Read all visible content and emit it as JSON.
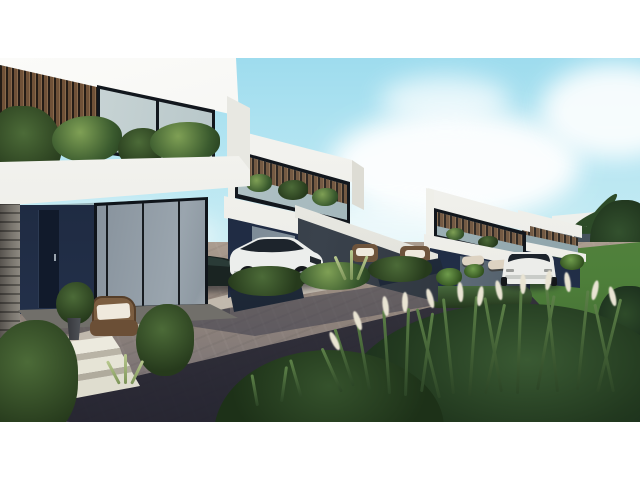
{
  "image": {
    "type": "3d-architectural-rendering",
    "subject": "Modern luxury villa development: row of white two-story villas with dark navy lower walls and wood-slat accents along a dark paver street, letterboxed with white bars",
    "elements": {
      "sky": "light blue sky with soft white clouds",
      "villa_1": "foreground villa with wood slat screen, glass balcony with plants, dark navy ground floor, wicker chair, white steps",
      "villa_2": "second villa with carport, white SUV and dark sports car parked in front",
      "villa_3": "third villa with patio loungers",
      "villa_4": "fourth receding villa",
      "distant_villa": "low flat-roof villa in far background right",
      "sedan": "white sedan driving away on street",
      "street": "herringbone paver street with long diagonal shadows",
      "landscaping": "hedges, planters, sunlit lawn, ornamental fountain grasses with white plumes, palm tree at right edge"
    }
  },
  "colors": {
    "letterbox": "#ffffff",
    "sky_top": "#9edcee",
    "sky_mid": "#cdeef4",
    "sky_horizon": "#eaf4ef",
    "cloud": "#ffffff",
    "fascia_white": "#f3f3f0",
    "wood_slat": "#6f5138",
    "wood_dark": "#241c16",
    "navy_wall": "#202c44",
    "stone": "#6f6b66",
    "street_lit": "#93867c",
    "street_shadow": "#3d3d49",
    "sidewalk": "#c6bfb2",
    "hedge": "#35522e",
    "lawn": "#4e7f3a",
    "grass_dark": "#15271a",
    "grass_blade": "#3a5a33",
    "plume": "#e9e4d3",
    "car_white": "#eceeec",
    "sports_car": "#1a2422",
    "wheel": "#14171a",
    "cushion": "#efe9dd",
    "palm_green": "#2d4b28"
  }
}
